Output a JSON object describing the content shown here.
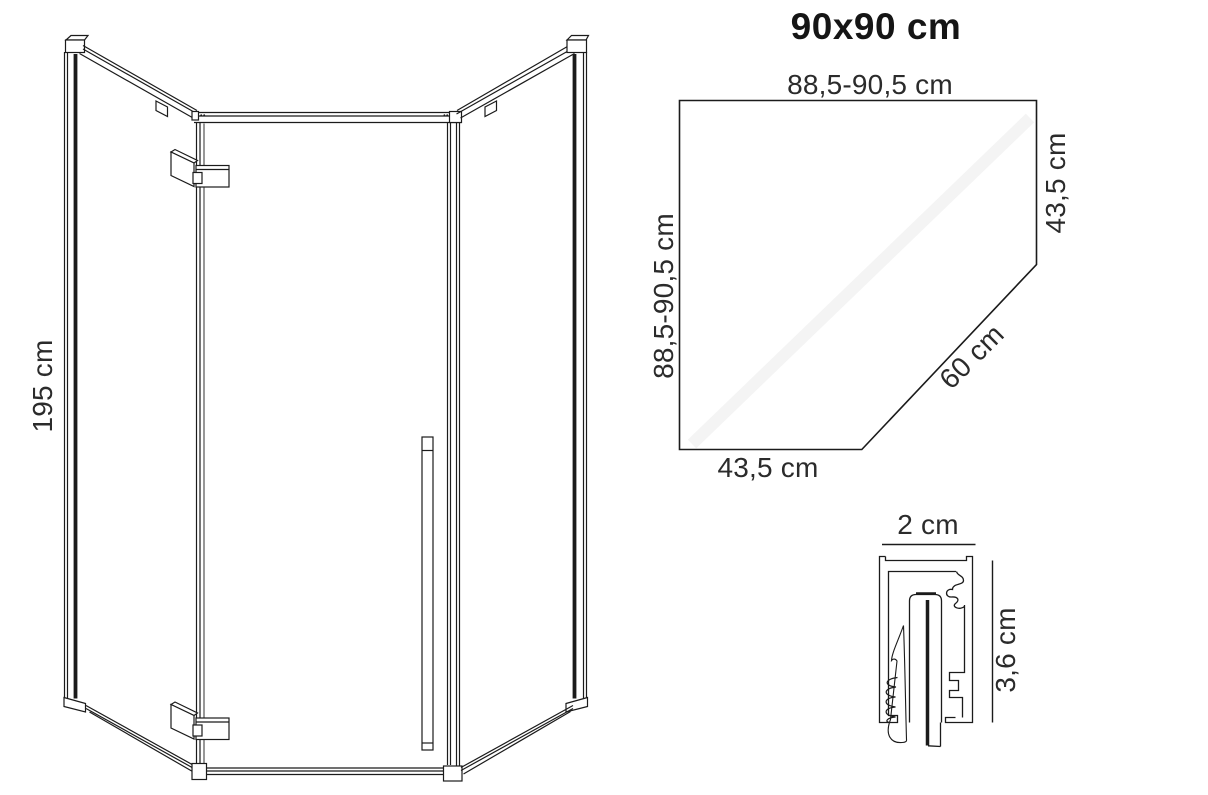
{
  "sheet": {
    "title": "90x90 cm"
  },
  "front_view": {
    "height_label": "195 cm"
  },
  "top_view": {
    "top_width_label": "88,5-90,5 cm",
    "left_depth_label": "88,5-90,5 cm",
    "right_side_label": "43,5 cm",
    "diagonal_label": "60 cm",
    "bottom_side_label": "43,5 cm"
  },
  "profile_view": {
    "width_label": "2 cm",
    "height_label": "3,6 cm"
  },
  "colors": {
    "line": "#1b1b1b",
    "label_text": "#2b2b2b",
    "title_text": "#151515",
    "background": "#ffffff"
  }
}
